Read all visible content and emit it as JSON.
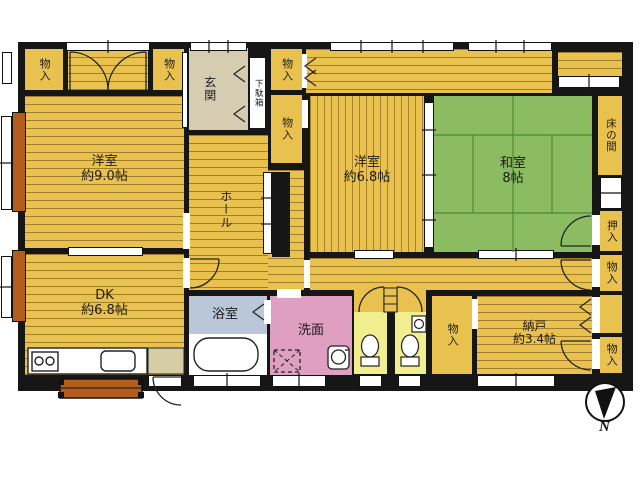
{
  "type": "japanese-house-floor-plan",
  "palette": {
    "wall": "#161616",
    "floor_wood": "#e9c14f",
    "tatami_green": "#8cbc62",
    "entry_beige": "#d5ccb2",
    "bath_blue": "#bac7d9",
    "washroom_pink": "#df9fc1",
    "toilet_yellow": "#f0ee8e",
    "veranda_wood_brown": "#b35d1d"
  },
  "rooms": {
    "youshitsu9": {
      "name": "洋室",
      "size": "約9.0帖"
    },
    "youshitsu68": {
      "name": "洋室",
      "size": "約6.8帖"
    },
    "washitsu": {
      "name": "和室",
      "size": "8帖"
    },
    "dk": {
      "name": "DK",
      "size": "約6.8帖"
    },
    "nando": {
      "name": "納戸",
      "size": "約3.4帖"
    },
    "genkan": {
      "name": "玄関"
    },
    "getabako": {
      "name": "下駄箱"
    },
    "hall": {
      "name": "ホール"
    },
    "tokonoma": {
      "name": "床の間"
    },
    "oshiire": {
      "name": "押入"
    },
    "senmen": {
      "name": "洗面"
    },
    "yokushitsu": {
      "name": "浴室"
    },
    "mono_ire": {
      "name": "物入"
    }
  },
  "compass": {
    "label": "N"
  }
}
